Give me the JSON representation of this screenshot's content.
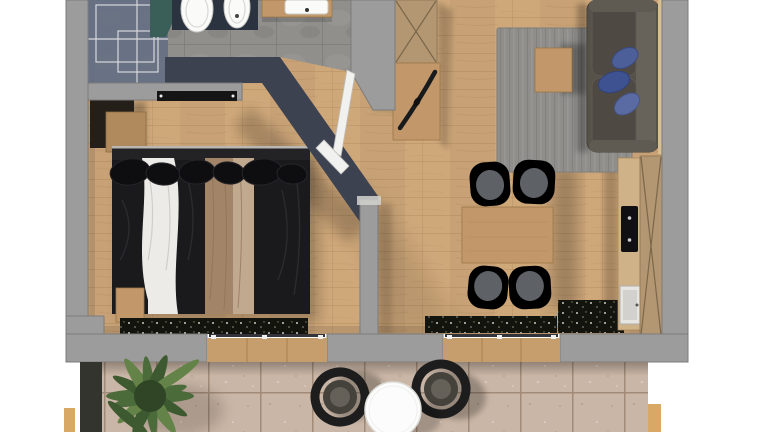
{
  "meta": {
    "title": "Apartment floor plan"
  },
  "scene": {
    "description": "Top-down 3D rendered floor plan of a one-bedroom apartment with terrace",
    "rooms": [
      {
        "name": "bathroom",
        "area": "top-left",
        "items": [
          "glass-shower",
          "toilet",
          "bidet",
          "vanity-washbasin"
        ]
      },
      {
        "name": "bedroom",
        "area": "left",
        "items": [
          "double-bed",
          "wardrobe",
          "bedside-bench",
          "wall-radiator",
          "window-flower-box"
        ]
      },
      {
        "name": "entrance-hall",
        "area": "center",
        "items": [
          "tall-wardrobe-cabinet",
          "sideboard",
          "decor-object",
          "bathroom-door",
          "bedroom-door"
        ]
      },
      {
        "name": "living-dining",
        "area": "right",
        "items": [
          "sofa",
          "blue-cushions",
          "area-rug",
          "coffee-table",
          "dining-table",
          "dining-chairs"
        ]
      },
      {
        "name": "kitchenette",
        "area": "right-wall",
        "items": [
          "counter",
          "cooktop",
          "sink",
          "tall-cabinet"
        ]
      },
      {
        "name": "terrace",
        "area": "bottom",
        "items": [
          "plant",
          "planter-box",
          "lounge-chairs",
          "round-table",
          "sliding-door-thresholds"
        ]
      }
    ],
    "counts": {
      "dining_chairs": 4,
      "terrace_chairs": 2,
      "sofa_cushions": 3,
      "bathroom_fixtures": 3,
      "cooktop_burners": 2
    }
  },
  "palette": {
    "bg": "#ffffff",
    "wall": "#9c9c9c",
    "wall-edge": "#7b7b7b",
    "navy-wall": "#3c4250",
    "wood-floor": "#cfa87a",
    "wood-line": "#b18b5d",
    "tile-bath": "#908f8c",
    "tile-grout": "#7d7c79",
    "rug": "#8f8e8b",
    "sofa": "#56524a",
    "chair-gray": "#53565a",
    "wood-furniture": "#c2986a",
    "cabinet-tan": "#b39772",
    "cabinet-line": "#6e5b40",
    "bed-black": "#1a1a1d",
    "bed-white": "#ecebe7",
    "bed-beige": "#a28468",
    "bed-beige-light": "#c1a98f",
    "terrace-tile": "#cab6a6",
    "terrace-grout": "#a18a77",
    "planter": "#34342e",
    "plant-green": "#4c6b3a",
    "plant-green-light": "#648348",
    "chair-black": "#1d1d1d",
    "table-white": "#fcfcfc",
    "glass": "#667083",
    "glass-teal": "#3a5f58",
    "fixture-white": "#fafaf9",
    "mat-navy": "#2b3340",
    "threshold": "#c69d6c",
    "door-white": "#f1f1ef"
  }
}
